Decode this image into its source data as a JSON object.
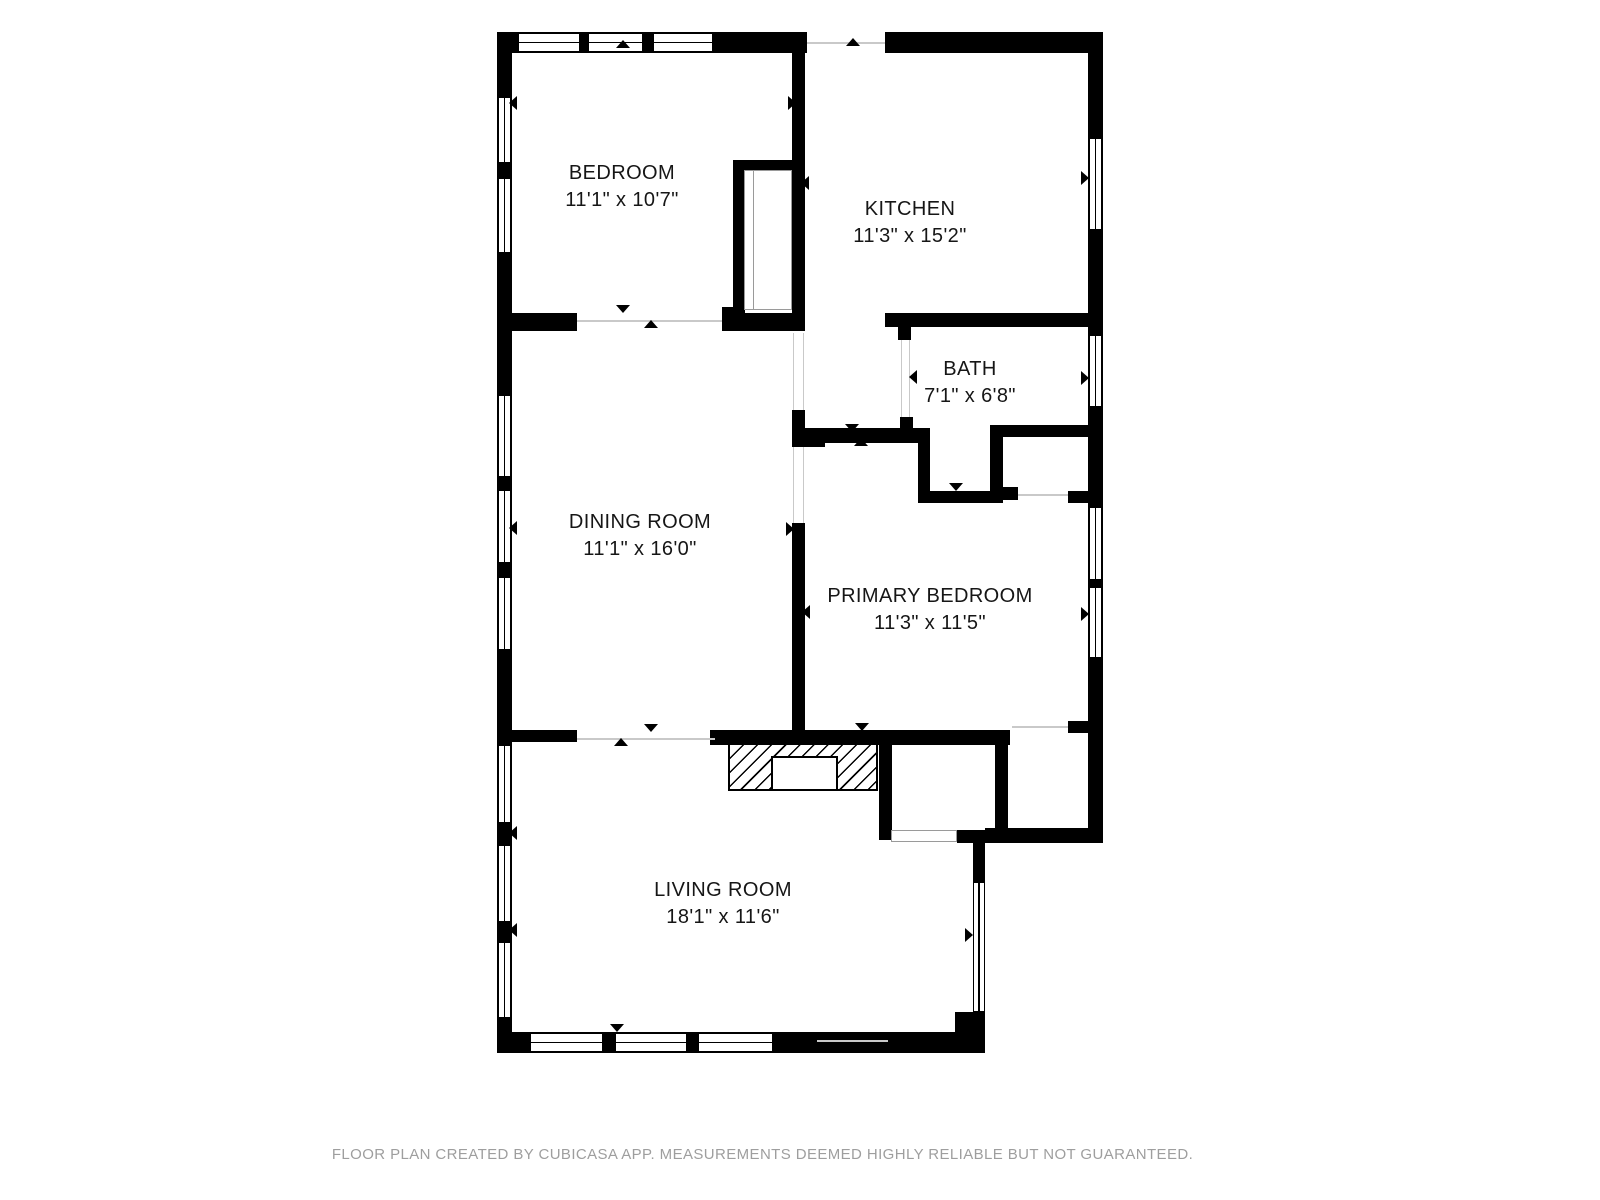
{
  "footer": {
    "text": "FLOOR PLAN CREATED BY CUBICASA APP. MEASUREMENTS DEEMED HIGHLY RELIABLE BUT NOT GUARANTEED."
  },
  "colors": {
    "wall": "#000000",
    "background": "#ffffff",
    "opening_line": "#c9c9c9",
    "footer_text": "#9e9e9e"
  },
  "rooms": [
    {
      "id": "bedroom",
      "name": "BEDROOM",
      "dims": "11'1\" x 10'7\"",
      "cx": 622,
      "top": 160
    },
    {
      "id": "kitchen",
      "name": "KITCHEN",
      "dims": "11'3\" x 15'2\"",
      "cx": 910,
      "top": 196
    },
    {
      "id": "bath",
      "name": "BATH",
      "dims": "7'1\" x 6'8\"",
      "cx": 970,
      "top": 356
    },
    {
      "id": "dining-room",
      "name": "DINING ROOM",
      "dims": "11'1\" x 16'0\"",
      "cx": 640,
      "top": 509
    },
    {
      "id": "primary-bedroom",
      "name": "PRIMARY BEDROOM",
      "dims": "11'3\" x 11'5\"",
      "cx": 930,
      "top": 583
    },
    {
      "id": "living-room",
      "name": "LIVING ROOM",
      "dims": "18'1\" x 11'6\"",
      "cx": 723,
      "top": 877
    }
  ],
  "plan": {
    "walls": [
      [
        497,
        32,
        310,
        21
      ],
      [
        885,
        32,
        218,
        21
      ],
      [
        497,
        32,
        15,
        1021
      ],
      [
        1088,
        32,
        15,
        811
      ],
      [
        497,
        1032,
        488,
        21
      ],
      [
        973,
        830,
        12,
        223
      ],
      [
        955,
        1012,
        30,
        41
      ],
      [
        985,
        828,
        118,
        15
      ],
      [
        792,
        53,
        13,
        278
      ],
      [
        733,
        160,
        60,
        11
      ],
      [
        733,
        160,
        12,
        157
      ],
      [
        722,
        307,
        23,
        16
      ],
      [
        512,
        313,
        65,
        18
      ],
      [
        722,
        313,
        83,
        18
      ],
      [
        885,
        313,
        218,
        14
      ],
      [
        898,
        313,
        13,
        27
      ],
      [
        900,
        417,
        13,
        21
      ],
      [
        792,
        410,
        13,
        37
      ],
      [
        803,
        428,
        22,
        19
      ],
      [
        801,
        428,
        119,
        15
      ],
      [
        792,
        523,
        13,
        210
      ],
      [
        918,
        428,
        12,
        75
      ],
      [
        918,
        491,
        85,
        12
      ],
      [
        990,
        425,
        13,
        78
      ],
      [
        990,
        425,
        113,
        12
      ],
      [
        1000,
        487,
        18,
        13
      ],
      [
        1068,
        491,
        20,
        12
      ],
      [
        1068,
        721,
        35,
        12
      ],
      [
        497,
        730,
        80,
        12
      ],
      [
        710,
        730,
        300,
        15
      ],
      [
        879,
        743,
        13,
        97
      ],
      [
        995,
        744,
        13,
        86
      ],
      [
        957,
        830,
        43,
        13
      ]
    ],
    "windows": [
      [
        518,
        33,
        62,
        19,
        "h"
      ],
      [
        588,
        33,
        55,
        19,
        "h"
      ],
      [
        653,
        33,
        60,
        19,
        "h"
      ],
      [
        498,
        97,
        13,
        66,
        "v"
      ],
      [
        498,
        178,
        13,
        75,
        "v"
      ],
      [
        498,
        395,
        13,
        82,
        "v"
      ],
      [
        498,
        490,
        13,
        73,
        "v"
      ],
      [
        498,
        577,
        13,
        73,
        "v"
      ],
      [
        498,
        745,
        13,
        78,
        "v"
      ],
      [
        498,
        845,
        13,
        77,
        "v"
      ],
      [
        498,
        942,
        13,
        76,
        "v"
      ],
      [
        1089,
        138,
        13,
        92,
        "v"
      ],
      [
        1089,
        335,
        13,
        72,
        "v"
      ],
      [
        1089,
        507,
        13,
        73,
        "v"
      ],
      [
        1089,
        587,
        13,
        71,
        "v"
      ],
      [
        530,
        1033,
        73,
        19,
        "h"
      ],
      [
        615,
        1033,
        72,
        19,
        "h"
      ],
      [
        698,
        1033,
        75,
        19,
        "h"
      ],
      [
        973,
        882,
        12,
        130,
        "v"
      ]
    ],
    "openings": [
      [
        807,
        42,
        78,
        2
      ],
      [
        577,
        320,
        145,
        2
      ],
      [
        793,
        333,
        1,
        77
      ],
      [
        803,
        333,
        1,
        77
      ],
      [
        793,
        447,
        1,
        76
      ],
      [
        803,
        447,
        1,
        76
      ],
      [
        901,
        340,
        1,
        77
      ],
      [
        909,
        340,
        1,
        77
      ],
      [
        577,
        738,
        138,
        2
      ],
      [
        1012,
        726,
        56,
        2
      ],
      [
        817,
        1040,
        71,
        2
      ],
      [
        1018,
        494,
        50,
        2
      ]
    ],
    "arrows": [
      [
        846,
        38,
        "up"
      ],
      [
        616,
        40,
        "up"
      ],
      [
        509,
        96,
        "left"
      ],
      [
        788,
        96,
        "right"
      ],
      [
        801,
        176,
        "left"
      ],
      [
        1081,
        171,
        "right"
      ],
      [
        616,
        305,
        "down"
      ],
      [
        644,
        320,
        "up"
      ],
      [
        930,
        314,
        "up"
      ],
      [
        909,
        370,
        "left"
      ],
      [
        1081,
        371,
        "right"
      ],
      [
        845,
        424,
        "down"
      ],
      [
        854,
        438,
        "up"
      ],
      [
        949,
        483,
        "down"
      ],
      [
        786,
        522,
        "right"
      ],
      [
        802,
        605,
        "left"
      ],
      [
        509,
        521,
        "left"
      ],
      [
        1081,
        607,
        "right"
      ],
      [
        644,
        724,
        "down"
      ],
      [
        614,
        738,
        "up"
      ],
      [
        855,
        723,
        "down"
      ],
      [
        509,
        826,
        "left"
      ],
      [
        509,
        923,
        "left"
      ],
      [
        965,
        928,
        "right"
      ],
      [
        610,
        1024,
        "down"
      ]
    ],
    "closet_outlines": [
      {
        "type": "rect",
        "x": 744,
        "y": 170,
        "w": 48,
        "h": 140
      },
      {
        "type": "line",
        "x": 753,
        "y": 170,
        "w": 1,
        "h": 140
      },
      {
        "type": "rect",
        "x": 891,
        "y": 830,
        "w": 66,
        "h": 12
      }
    ],
    "fireplace": {
      "x": 728,
      "y": 743,
      "w": 150,
      "h": 48,
      "inner": {
        "x": 771,
        "y": 756,
        "w": 67,
        "h": 35
      }
    }
  }
}
